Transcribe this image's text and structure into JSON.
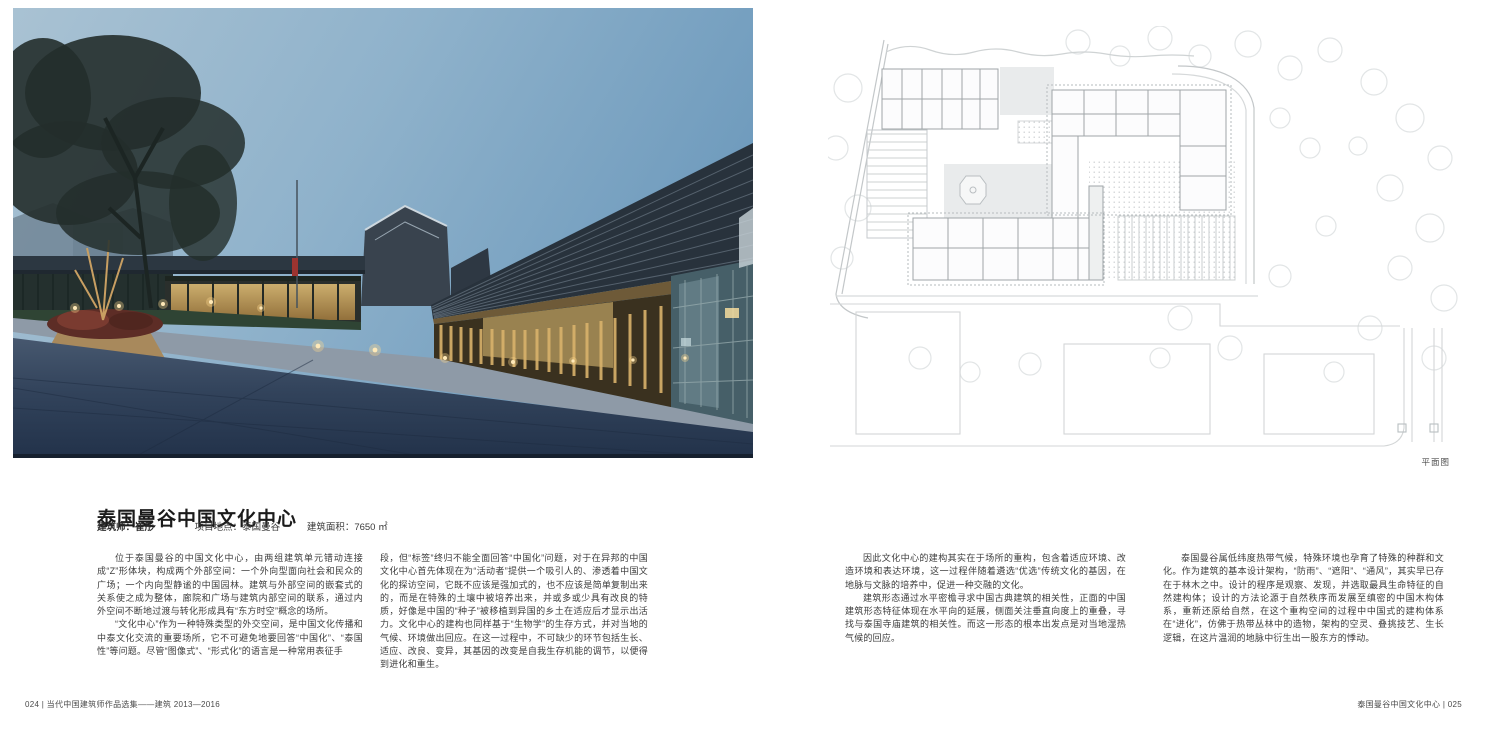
{
  "article": {
    "title": "泰国曼谷中国文化中心",
    "byline": {
      "architect": "建筑师：崔彤",
      "location": "项目地点：泰国曼谷",
      "area": "建筑面积：7650 ㎡"
    }
  },
  "text": {
    "col1_p1": "位于泰国曼谷的中国文化中心，由两组建筑单元错动连接成“Z”形体块，构成两个外部空间：一个外向型面向社会和民众的广场；一个内向型静谧的中国园林。建筑与外部空间的嵌套式的关系使之成为整体，廊院和广场与建筑内部空间的联系，通过内外空间不断地过渡与转化形成具有“东方时空”概念的场所。",
    "col1_p2": "“文化中心”作为一种特殊类型的外交空间，是中国文化传播和中泰文化交流的重要场所，它不可避免地要回答“中国化”、“泰国性”等问题。尽管“图像式”、“形式化”的语言是一种常用表征手",
    "col2_p1": "段，但“标签”终归不能全面回答“中国化”问题，对于在异邦的中国文化中心首先体现在为“活动者”提供一个吸引人的、渗透着中国文化的探访空间，它既不应该是强加式的，也不应该是简单复制出来的，而是在特殊的土壤中被培养出来，并或多或少具有改良的特质，好像是中国的“种子”被移植到异国的乡土在适应后才显示出活力。文化中心的建构也同样基于“生物学”的生存方式，并对当地的气候、环境做出回应。在这一过程中，不可缺少的环节包括生长、适应、改良、变异，其基因的改变是自我生存机能的调节，以便得到进化和重生。",
    "col3_p1": "因此文化中心的建构其实在于场所的重构，包含着适应环境、改造环境和表达环境，这一过程伴随着遴选“优选”传统文化的基因，在地脉与文脉的培养中，促进一种交融的文化。",
    "col3_p2": "建筑形态通过水平密檐寻求中国古典建筑的相关性，正面的中国建筑形态特征体现在水平向的延展，侧面关注垂直向度上的重叠，寻找与泰国寺庙建筑的相关性。而这一形态的根本出发点是对当地湿热气候的回应。",
    "col4_p1": "泰国曼谷属低纬度热带气候，特殊环境也孕育了特殊的种群和文化。作为建筑的基本设计架构，“防雨”、“遮阳”、“通风”，其实早已存在于林木之中。设计的程序是观察、发现，并选取最具生命特征的自然建构体；设计的方法论源于自然秩序而发展至缜密的中国木构体系，重新还原给自然，在这个重构空间的过程中中国式的建构体系在“进化”，仿佛于热带丛林中的造物，架构的空灵、叠挑技艺、生长逻辑，在这片温润的地脉中衍生出一股东方的悸动。"
  },
  "plan": {
    "caption": "平面图"
  },
  "footer": {
    "left": "024 | 当代中国建筑师作品选集——建筑 2013—2016",
    "right": "泰国曼谷中国文化中心 | 025"
  },
  "colors": {
    "sky_top": "#a9c2d3",
    "sky_deep": "#6f9bbd",
    "warm_light": "#e8c479",
    "plaza_foreground": "#2a3950",
    "plan_line": "#b9bec1"
  }
}
